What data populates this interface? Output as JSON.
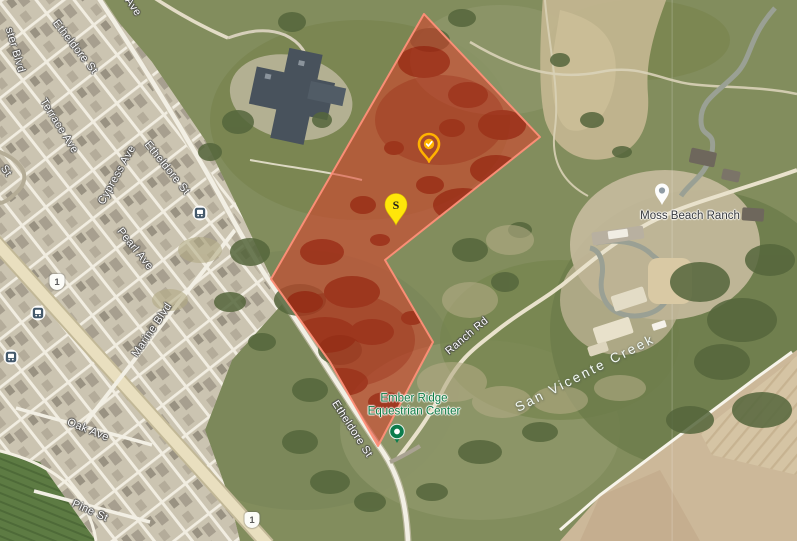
{
  "map": {
    "view": "satellite",
    "parcel_overlay": {
      "name": "highlighted red parcel",
      "fill": "#e13a27",
      "fill_opacity": 0.52,
      "stroke": "#ff8f78",
      "points": "424,14 540,137 385,260 433,342 378,446 330,362 271,279"
    },
    "markers": {
      "check_pin": {
        "icon": "check-pin",
        "color": "#ffb300",
        "check_color": "#ffffff"
      },
      "s_pin": {
        "label": "S",
        "color": "#ffe60a",
        "text_color": "#1d1d1d"
      },
      "moss_beach_ranch_pin": {
        "icon": "place-pin",
        "color": "#ffffff",
        "dot_color": "#909ca4"
      },
      "equestrian_marker": {
        "icon": "poi-dot",
        "color": "#0c7c4c",
        "dot_color": "#ffffff"
      }
    },
    "route_shields": [
      {
        "label": "1"
      },
      {
        "label": "1"
      }
    ],
    "transit_stops": [
      {
        "name": "bus stop"
      },
      {
        "name": "bus stop"
      },
      {
        "name": "bus stop"
      }
    ],
    "road_labels": [
      {
        "text": "Etheldore St"
      },
      {
        "text": "Etheldore St"
      },
      {
        "text": "Etheldore St"
      },
      {
        "text": "Terrace Ave"
      },
      {
        "text": "Cypress Ave"
      },
      {
        "text": "Pearl Ave"
      },
      {
        "text": "Marine Blvd"
      },
      {
        "text": "Oak Ave"
      },
      {
        "text": "Pine St"
      },
      {
        "text": "Ranch Rd"
      },
      {
        "text": "ster Blvd"
      },
      {
        "text": "Ave"
      },
      {
        "text": "St"
      }
    ],
    "poi_labels": {
      "moss_beach_ranch": {
        "text": "Moss Beach Ranch",
        "color": "#36393d"
      },
      "ember_ridge": {
        "line1": "Ember Ridge",
        "line2": "Equestrian Center",
        "color": "#0e7b45"
      }
    },
    "water_labels": [
      {
        "text": "San Vicente Creek",
        "color": "#f3f9f4"
      }
    ]
  }
}
